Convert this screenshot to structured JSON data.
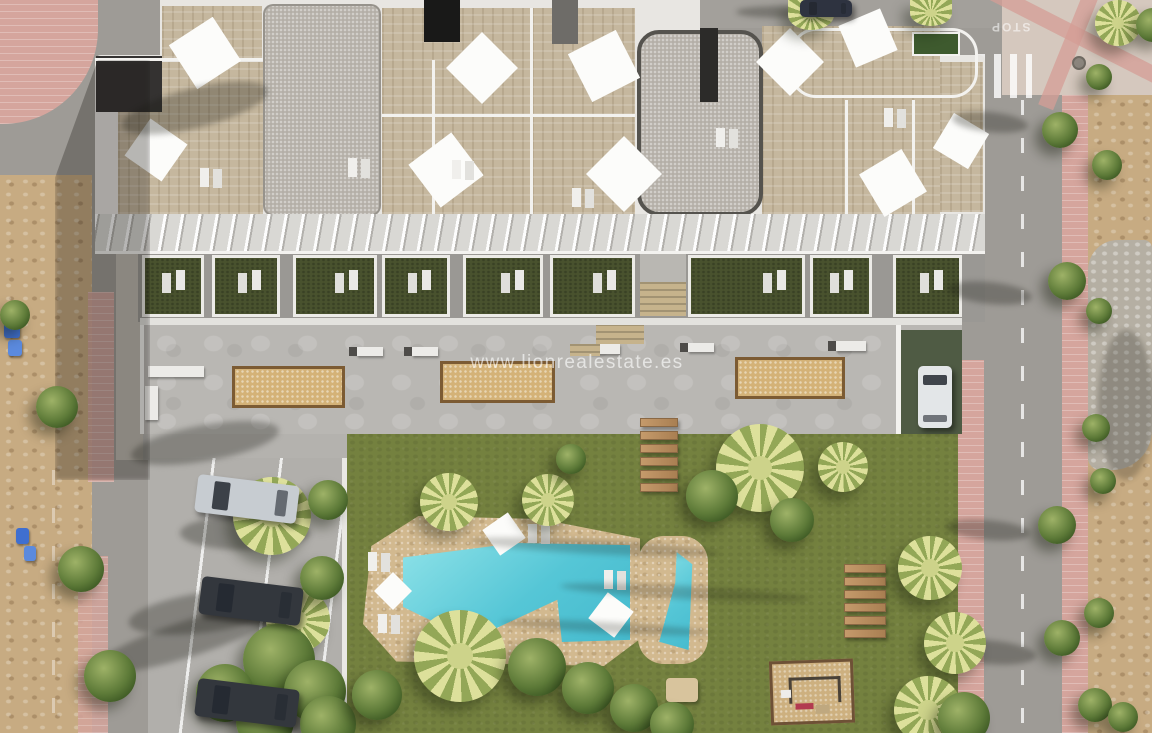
{
  "watermark": {
    "text": "www.lionrealestate.es"
  },
  "road": {
    "stop_marking": "STOP"
  },
  "colors": {
    "asphalt": "#9e9b96",
    "asphalt_top": "#a3a09b",
    "sidewalk_pink": "#d5a59d",
    "sidewalk_pale": "#bdb9b1",
    "plaza_top_right": "#d5c8be",
    "plaza_cross_pink": "#d49e96",
    "dirt": "#c7ab82",
    "dirt_rocky": "#b5afa3",
    "building_white": "#e8e6e2",
    "roof_tile": "#c5b79e",
    "roof_gravel": "#b4afa7",
    "roof_dark": "#343231",
    "canopy": "#d9d8d4",
    "white_rail": "#f3f2ef",
    "terrace_grass": "#49522e",
    "terrace_backdrop": "#9a9894",
    "plaza_concrete": "#b9b7b3",
    "sand_pit": "#d4b277",
    "pit_border": "#7c5b33",
    "bench_white": "#ecebe8",
    "lawn": "#74813f",
    "pool_deck": "#d2b98f",
    "pool_water": "#55c6d6",
    "pool_water_light": "#8ee2e8",
    "wood_plank": "#b98a5c",
    "playground_sand": "#cdb07f",
    "driveway_green": "#4f5b44",
    "roof_garden_green": "#3e5a2e",
    "car_white": "#e3e6e8",
    "car_dark": "#33373d",
    "car_silver": "#c7ccd1",
    "bin_blue": "#3f6fd0",
    "tree_dark": "#36521f",
    "tree_light": "#9eb267",
    "palm_light": "#dde09b",
    "watermark_color": "rgba(255,255,255,0.62)"
  },
  "scene": {
    "pools_count": 2,
    "wood_steps_per_path": 6,
    "parked_cars_count": 5
  }
}
